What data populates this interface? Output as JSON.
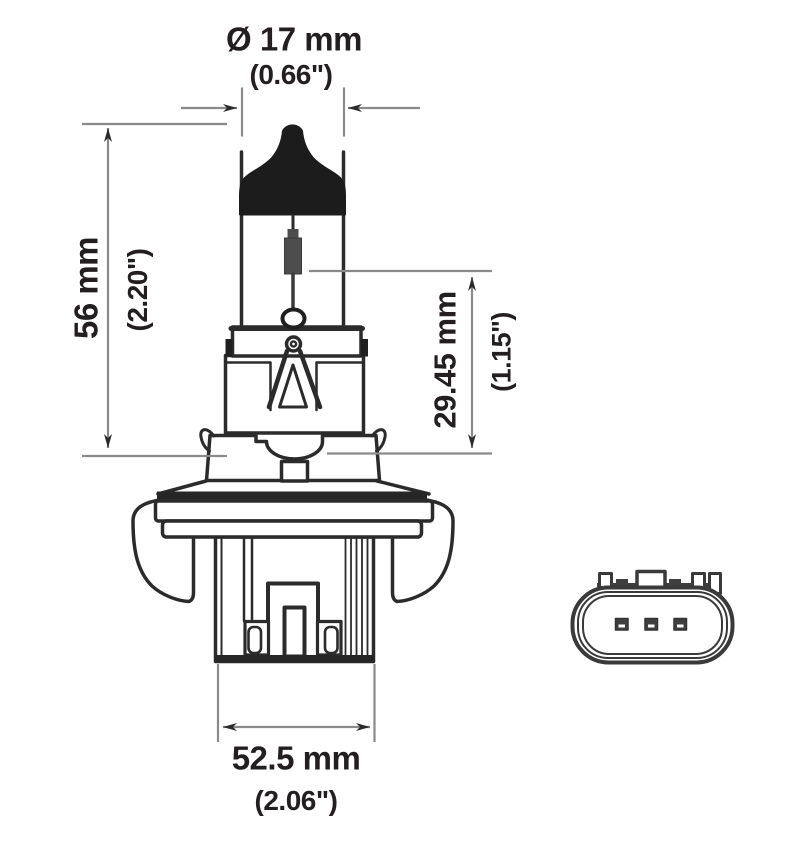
{
  "colors": {
    "line": "#2b2b2b",
    "dimension_line": "#8a8a8a",
    "fill_black": "#1c1c1c",
    "background": "#ffffff"
  },
  "dimensions": {
    "diameter": {
      "metric": "Ø 17 mm",
      "imperial": "(0.66\")"
    },
    "overall_length": {
      "metric": "56 mm",
      "imperial": "(2.20\")"
    },
    "base_length": {
      "metric": "29.45 mm",
      "imperial": "(1.15\")"
    },
    "base_width": {
      "metric": "52.5 mm",
      "imperial": "(2.06\")"
    }
  }
}
